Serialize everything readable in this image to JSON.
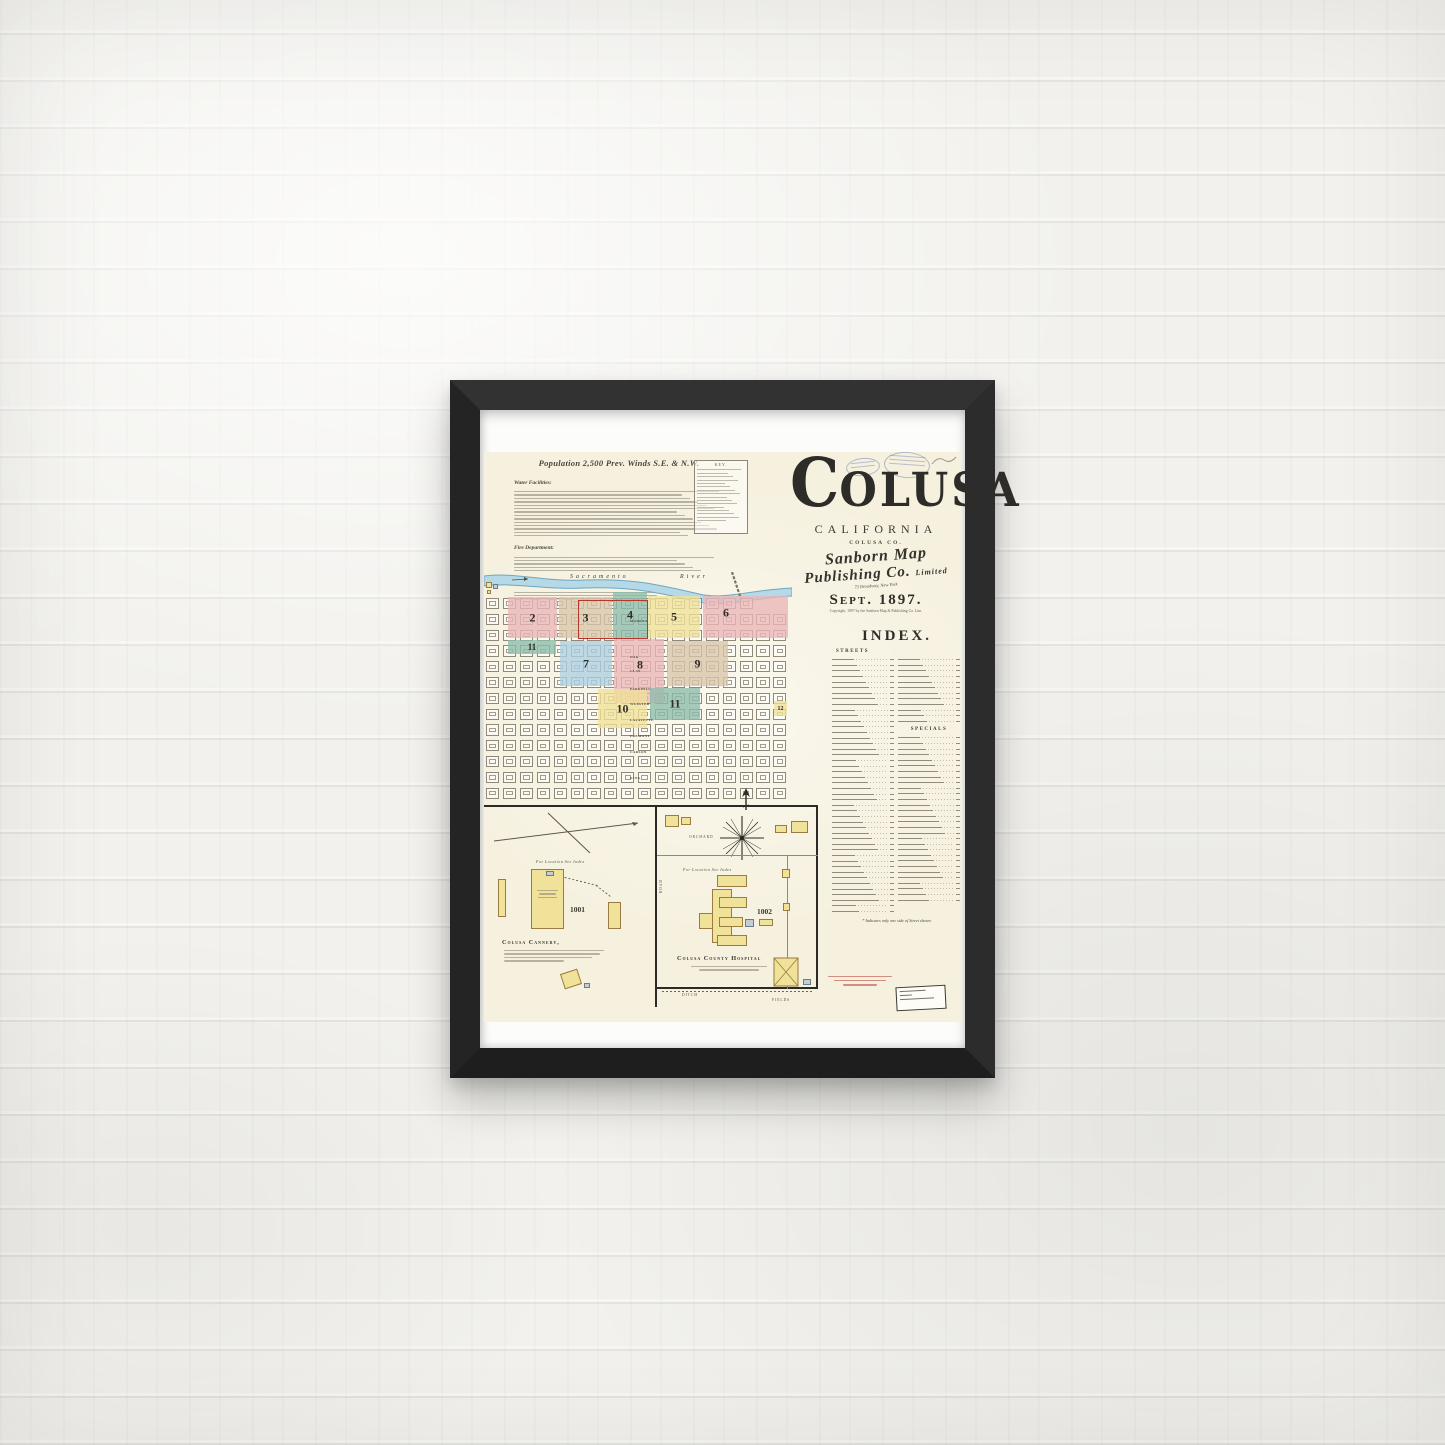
{
  "scene": {
    "wall_color": "#f2f1ed",
    "frame_color": "#282828"
  },
  "map_sheet": {
    "header": {
      "population_line": "Population 2,500  Prev. Winds S.E. & N.W.",
      "water_facilities_label": "Water Facilities:",
      "fire_department_label": "Fire Department:",
      "note_label": "Note:"
    },
    "key": {
      "label": "KEY."
    },
    "title_block": {
      "city_initial": "C",
      "city_rest": "OLUSA",
      "state": "CALIFORNIA",
      "county": "COLUSA CO.",
      "publisher_line1": "Sanborn Map",
      "publisher_line2": "Publishing Co.",
      "publisher_suffix": "Limited",
      "publisher_address": "73 Broadway, New York",
      "date_line": "Sept. 1897.",
      "copyright_line": "Copyright, 1897 by the Sanborn Map & Publishing Co. Lim."
    },
    "map": {
      "river_label_left": "Sacramento",
      "river_label_right": "River",
      "districts": [
        {
          "sheet": "2",
          "color": "pink",
          "x": 24,
          "y": 25,
          "w": 49,
          "h": 41
        },
        {
          "sheet": "3",
          "color": "tan",
          "x": 75,
          "y": 25,
          "w": 53,
          "h": 41
        },
        {
          "sheet": "4",
          "color": "teal",
          "x": 129,
          "y": 20,
          "w": 34,
          "h": 46
        },
        {
          "sheet": "5",
          "color": "yellow",
          "x": 164,
          "y": 24,
          "w": 52,
          "h": 42
        },
        {
          "sheet": "6",
          "color": "pink",
          "x": 219,
          "y": 24,
          "w": 85,
          "h": 42,
          "lx": 242,
          "ly": 41
        },
        {
          "sheet": "11",
          "color": "teal",
          "x": 24,
          "y": 68,
          "w": 48,
          "h": 14,
          "fs": 9
        },
        {
          "sheet": "7",
          "color": "blue",
          "x": 76,
          "y": 69,
          "w": 52,
          "h": 45
        },
        {
          "sheet": "8",
          "color": "pink",
          "x": 130,
          "y": 67,
          "w": 50,
          "h": 64,
          "lx": 156,
          "ly": 93
        },
        {
          "sheet": "9",
          "color": "tan",
          "x": 183,
          "y": 69,
          "w": 61,
          "h": 45
        },
        {
          "sheet": "10",
          "color": "yellow",
          "x": 114,
          "y": 117,
          "w": 49,
          "h": 39
        },
        {
          "sheet": "11",
          "color": "teal",
          "x": 166,
          "y": 116,
          "w": 50,
          "h": 32
        },
        {
          "sheet": "12",
          "color": "yellow",
          "x": 290,
          "y": 129,
          "w": 13,
          "h": 15,
          "fs": 6
        }
      ],
      "streets": [
        {
          "name": "MARKET",
          "y": 47
        },
        {
          "name": "OAK",
          "y": 83
        },
        {
          "name": "CLAY",
          "y": 97
        },
        {
          "name": "PARKHILL",
          "y": 115
        },
        {
          "name": "WEBSTER",
          "y": 130
        },
        {
          "name": "LAFAYETTE",
          "y": 146
        },
        {
          "name": "FREMONT",
          "y": 162
        },
        {
          "name": "CARSON",
          "y": 178
        },
        {
          "name": "KING",
          "y": 204
        }
      ]
    },
    "index": {
      "title": "INDEX.",
      "streets_heading": "STREETS",
      "specials_heading": "SPECIALS",
      "footnote": "* Indicates only one side of Street shown."
    },
    "insets": {
      "cannery": {
        "location_note": "For Location See Index",
        "number": "1001",
        "caption": "Colusa Cannery,"
      },
      "hospital": {
        "location_note": "For Location See Index",
        "number": "1002",
        "caption": "Colusa County Hospital",
        "orchard_label": "ORCHARD",
        "road_label": "ROAD",
        "ditch_label": "DITCH",
        "fields_label": "FIELDS"
      }
    },
    "colors": {
      "paper": "#f6f1df",
      "pink": "#eab6b8",
      "tan": "#d8c5a9",
      "teal": "#8cbcab",
      "yellow": "#f0e198",
      "blue": "#accfe0",
      "river_fill": "#b5d9e6",
      "river_stroke": "#6fa7bf",
      "red_outline": "#b5372c"
    }
  }
}
